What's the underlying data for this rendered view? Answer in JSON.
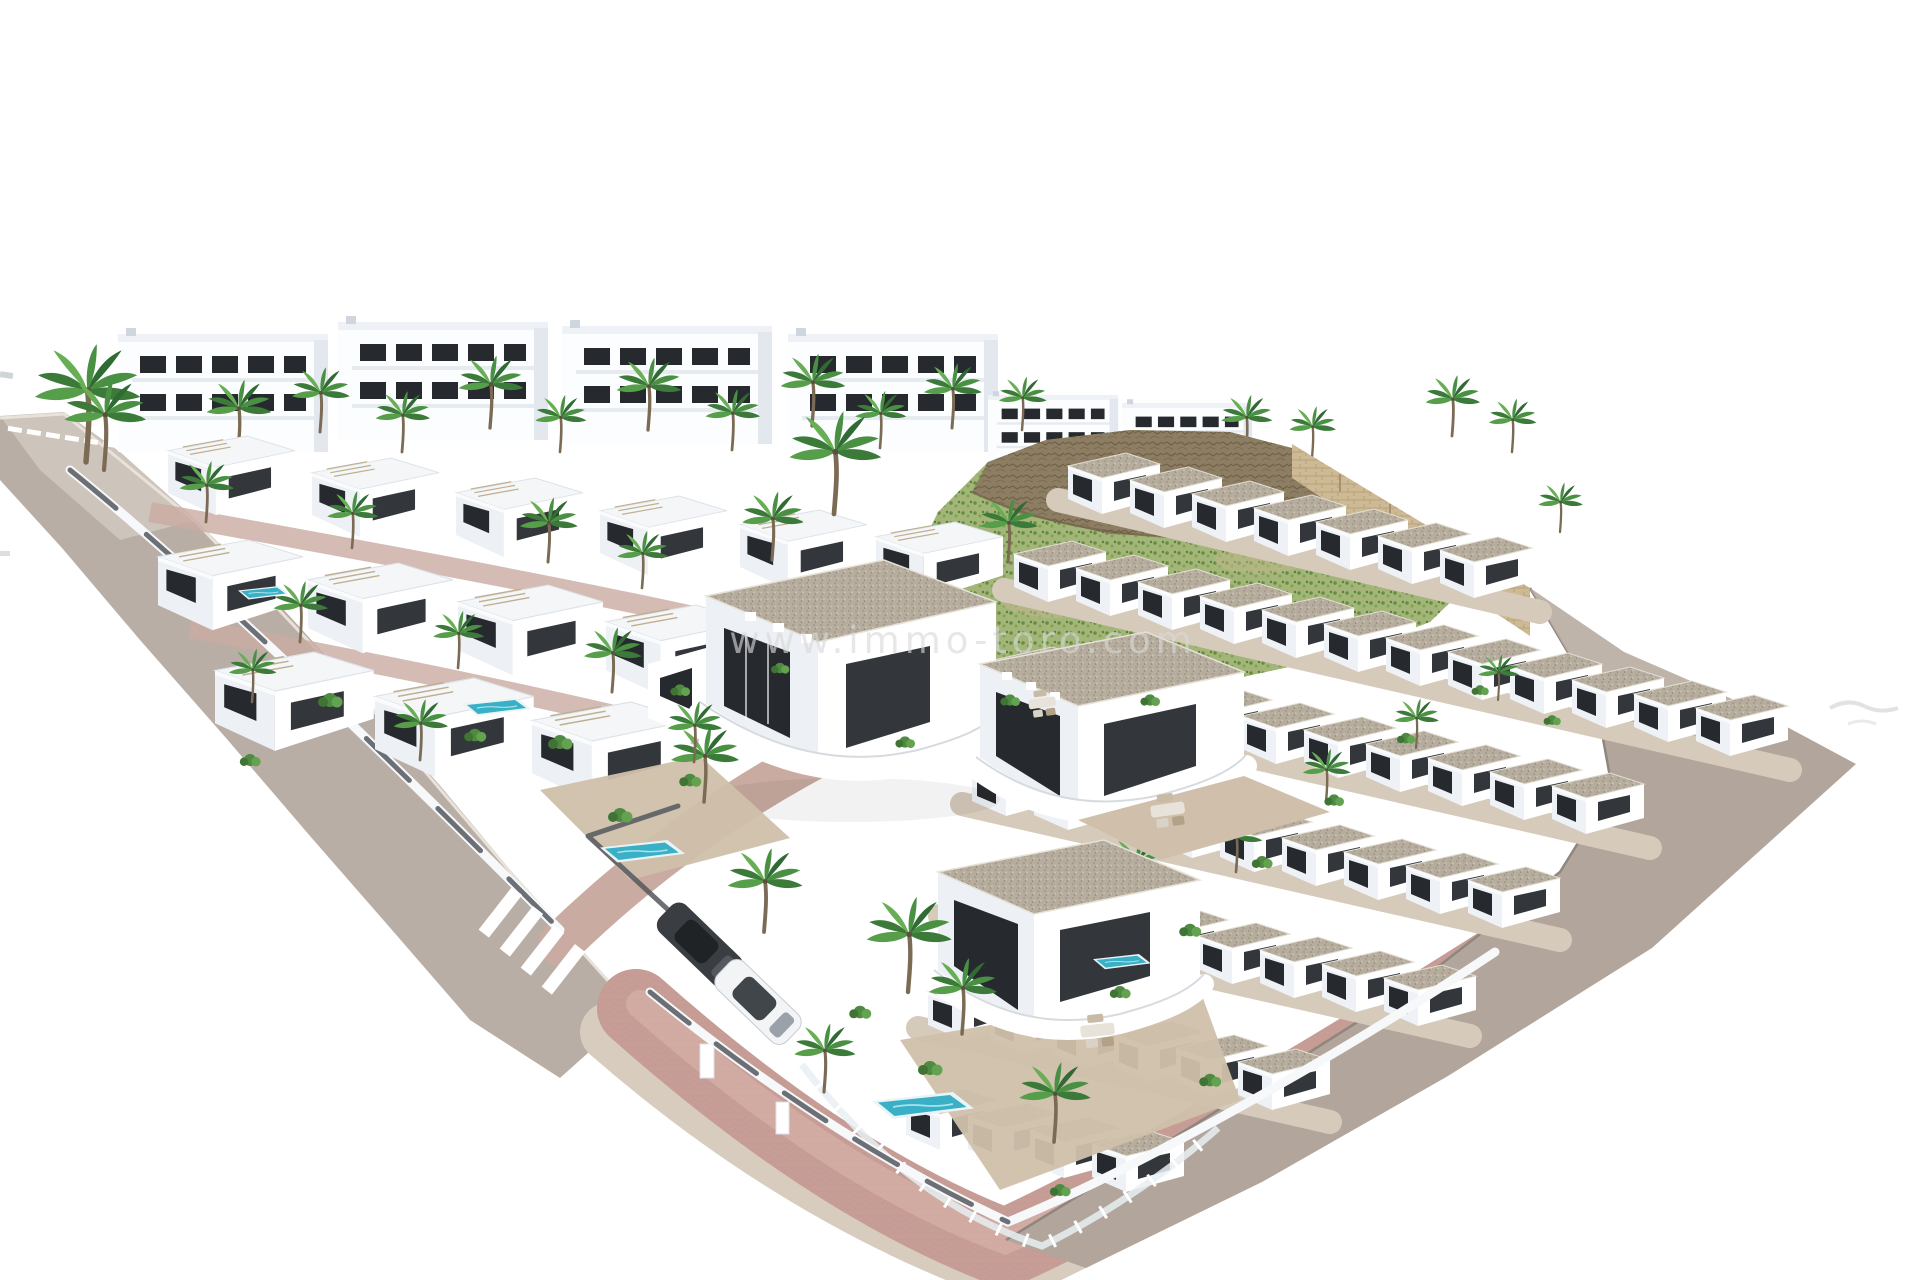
{
  "watermark": {
    "text": "www.immo-toro.com"
  },
  "palette": {
    "background": "#ffffff",
    "road": "#b9aea5",
    "road_light": "#d6cdc5",
    "sidewalk": "#d8ccbf",
    "paving_pink": "#c79e97",
    "paving_pink_light": "#d9b4ac",
    "paving_internal": "#c9aba1",
    "embankment": "#b1a59c",
    "crosswalk_white": "#ffffff",
    "villa_white": "#ffffff",
    "villa_shade": "#edf0f4",
    "window_dark": "#26292d",
    "gravel_roof": "#b6ad9e",
    "palm_green": "#499043",
    "palm_trunk": "#7c6b54",
    "bush_green": "#4e8a41",
    "hill_green": "#a3b578",
    "hill_rock": "#8d7d62",
    "stone_wall": "#cdb994",
    "pool_water": "#3ab0c6",
    "fence_dark": "#4e5257",
    "patio_tan": "#d0c0ab",
    "car_dark": "#3a3d41",
    "car_white": "#f2f4f6",
    "watermark_gray": "#d9d9d9"
  }
}
